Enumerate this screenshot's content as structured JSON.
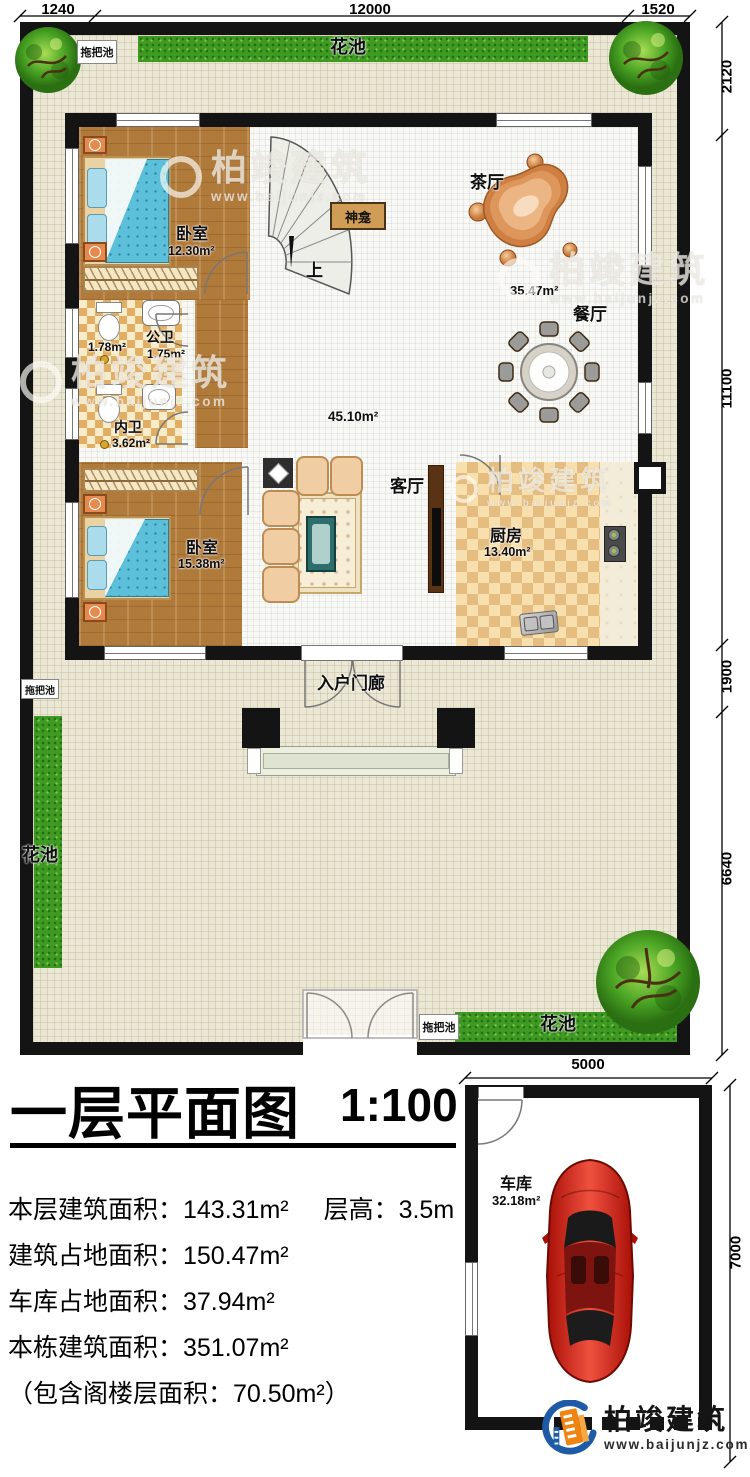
{
  "title": {
    "main": "一层平面图",
    "scale": "1:100"
  },
  "stats": {
    "line1a": "本层建筑面积：143.31m²",
    "line1b": "层高：3.5m",
    "line2": "建筑占地面积：150.47m²",
    "line3": "车库占地面积：37.94m²",
    "line4": "本栋建筑面积：351.07m²",
    "line5": "（包含阁楼层面积：70.50m²）"
  },
  "labels": {
    "dim_1240": "1240",
    "dim_12000": "12000",
    "dim_1520": "1520",
    "dim_2120": "2120",
    "dim_11100": "11100",
    "dim_1900": "1900",
    "dim_6640": "6640",
    "dim_5000": "5000",
    "dim_7000": "7000"
  },
  "rooms": {
    "bedroom1": {
      "name": "卧室",
      "area": "12.30m²"
    },
    "bedroom2": {
      "name": "卧室",
      "area": "15.38m²"
    },
    "public_bath": {
      "name": "公卫",
      "area": "1.75m²",
      "area2": "1.78m²"
    },
    "inner_bath": {
      "name": "内卫",
      "area": "3.62m²"
    },
    "tea": {
      "name": "茶厅"
    },
    "dining": {
      "name": "餐厅",
      "area": "35.47m²"
    },
    "living": {
      "name": "客厅",
      "area": "45.10m²"
    },
    "kitchen": {
      "name": "厨房",
      "area": "13.40m²"
    },
    "porch": {
      "name": "入户门廊"
    },
    "garage": {
      "name": "车库",
      "area": "32.18m²"
    },
    "shrine": {
      "name": "神龛"
    },
    "stairs": {
      "up": "上"
    }
  },
  "site": {
    "flower_bed": "花池",
    "mop_pool": "拖把池"
  },
  "watermark": {
    "brand": "柏竣建筑",
    "url": "www.baijunjz.com"
  },
  "logo": {
    "brand": "柏竣建筑",
    "url": "www.baijunjz.com"
  },
  "colors": {
    "wall": "#141414",
    "grass": "#3e9a23",
    "wood": "#b07a3b",
    "mattress": "#5cc0da",
    "accent_blue": "#1d5ba6",
    "accent_orange": "#ee8512",
    "car_red": "#c11208"
  }
}
